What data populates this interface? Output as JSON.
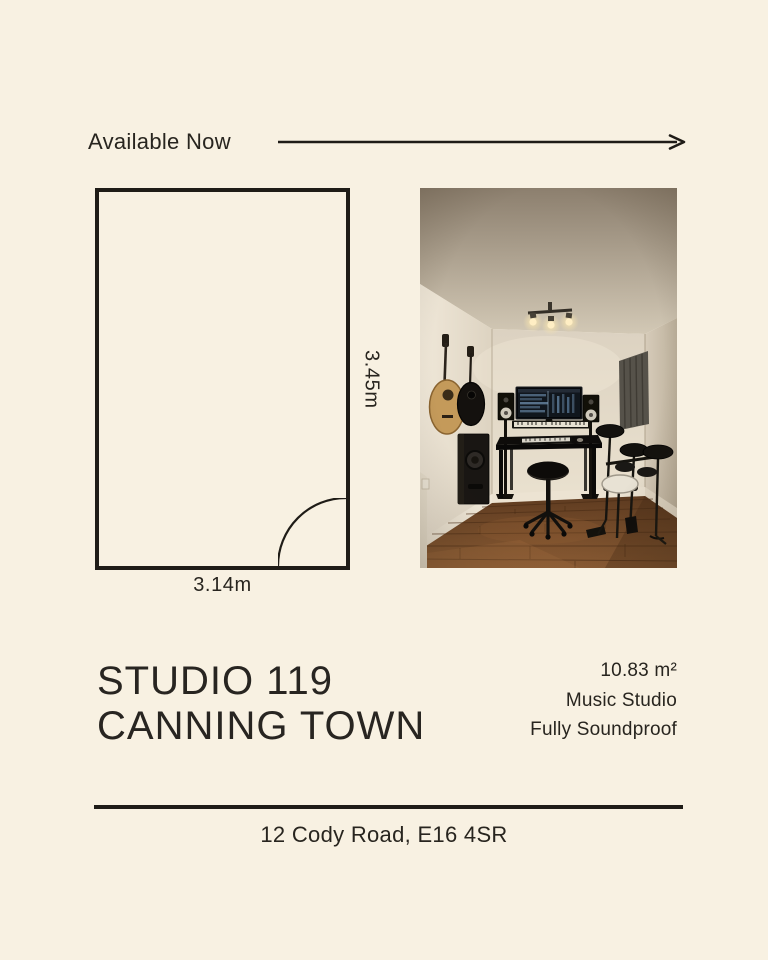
{
  "flyer": {
    "availability": "Available Now",
    "floorplan": {
      "width_label": "3.14m",
      "height_label": "3.45m"
    },
    "title": {
      "line1": "STUDIO 119",
      "line2": "CANNING TOWN"
    },
    "details": {
      "area": "10.83 m²",
      "type": "Music Studio",
      "feature": "Fully Soundproof"
    },
    "address": "12 Cody Road, E16 4SR",
    "photo": {
      "description": "Music studio room: two wall-hung guitars, desk with monitor and studio speakers, keyboard, stool, electronic drum kit, acoustic foam panel, wooden floor"
    }
  },
  "colors": {
    "background": "#f8f1e2",
    "text": "#2b2721",
    "line": "#1f1c17"
  }
}
